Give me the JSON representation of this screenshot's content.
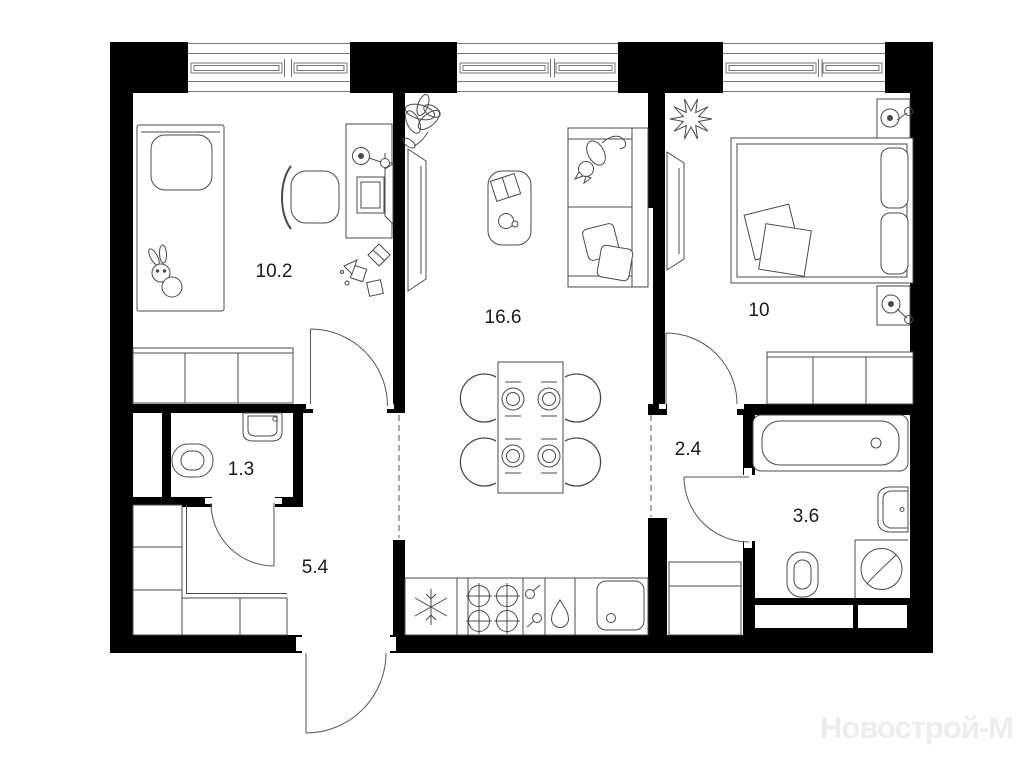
{
  "document": {
    "type": "apartment-floor-plan",
    "total_rooms": 7
  },
  "watermark": {
    "text": "Новострой-М",
    "color": "#ededed"
  },
  "colors": {
    "wall": "#000000",
    "furniture_line": "#4a4a4a",
    "window_line": "#777777",
    "label": "#1a1a1a",
    "background": "#ffffff"
  },
  "rooms": [
    {
      "name": "child-bedroom",
      "area": "10.2",
      "fixtures": [
        "single-bed",
        "plush-bunny",
        "wardrobe",
        "desk",
        "monitor",
        "desk-lamp",
        "office-chair",
        "toys",
        "window"
      ]
    },
    {
      "name": "living-room-kitchen",
      "area": "16.6",
      "fixtures": [
        "plant",
        "tv",
        "coffee-table",
        "sofa",
        "cat",
        "cushions",
        "dining-table",
        "chairs",
        "fridge",
        "stove",
        "dishwasher",
        "kitchen-sink",
        "window"
      ]
    },
    {
      "name": "bedroom",
      "area": "10",
      "fixtures": [
        "double-bed",
        "pillows",
        "nightstand-lamp",
        "nightstand-lamp",
        "plant",
        "tv",
        "wardrobe",
        "window"
      ]
    },
    {
      "name": "bathroom-guest",
      "area": "1.3",
      "fixtures": [
        "washbasin",
        "toilet"
      ]
    },
    {
      "name": "hallway",
      "area": "5.4",
      "fixtures": [
        "closet",
        "entrance-door"
      ]
    },
    {
      "name": "corridor",
      "area": "2.4",
      "fixtures": [
        "cabinet"
      ]
    },
    {
      "name": "bathroom-main",
      "area": "3.6",
      "fixtures": [
        "bathtub",
        "washbasin",
        "toilet",
        "washing-machine"
      ]
    }
  ]
}
